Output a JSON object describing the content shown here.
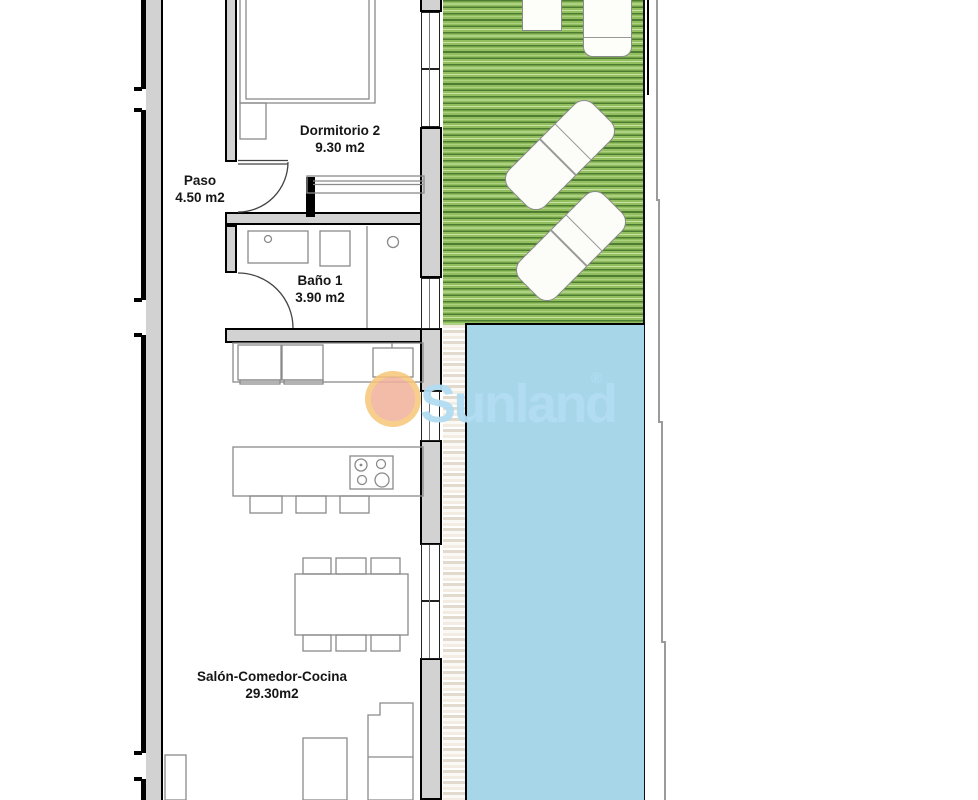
{
  "page": {
    "type": "floor-plan",
    "description": "Apartment floor plan with garden and pool"
  },
  "rooms": [
    {
      "id": "dormitorio2",
      "name": "Dormitorio 2",
      "area": "9.30 m2"
    },
    {
      "id": "paso",
      "name": "Paso",
      "area": "4.50 m2"
    },
    {
      "id": "bano1",
      "name": "Baño 1",
      "area": "3.90 m2"
    },
    {
      "id": "salon",
      "name": "Salón-Comedor-Cocina",
      "area": "29.30m2"
    }
  ],
  "brand": {
    "logo_text": "Sunland",
    "registered_mark": "®"
  },
  "colors": {
    "garden-base": "#93c05e",
    "garden-stripe": "#4e7c33",
    "garden-dot-row": "#c8dfa6",
    "pool": "#a7d6e9",
    "deck-light": "#f2ece3",
    "deck-dark": "#e2dacd",
    "wall-fill": "#d2d2d2",
    "wall-edge": "#000000",
    "furniture-line": "#8a8a8a",
    "boundary-gray": "#9b9b9b",
    "logo-blue": "#b2ddf2",
    "sun-outer": "#f7c577",
    "sun-inner": "#f1b09a",
    "label-color": "#161616"
  }
}
